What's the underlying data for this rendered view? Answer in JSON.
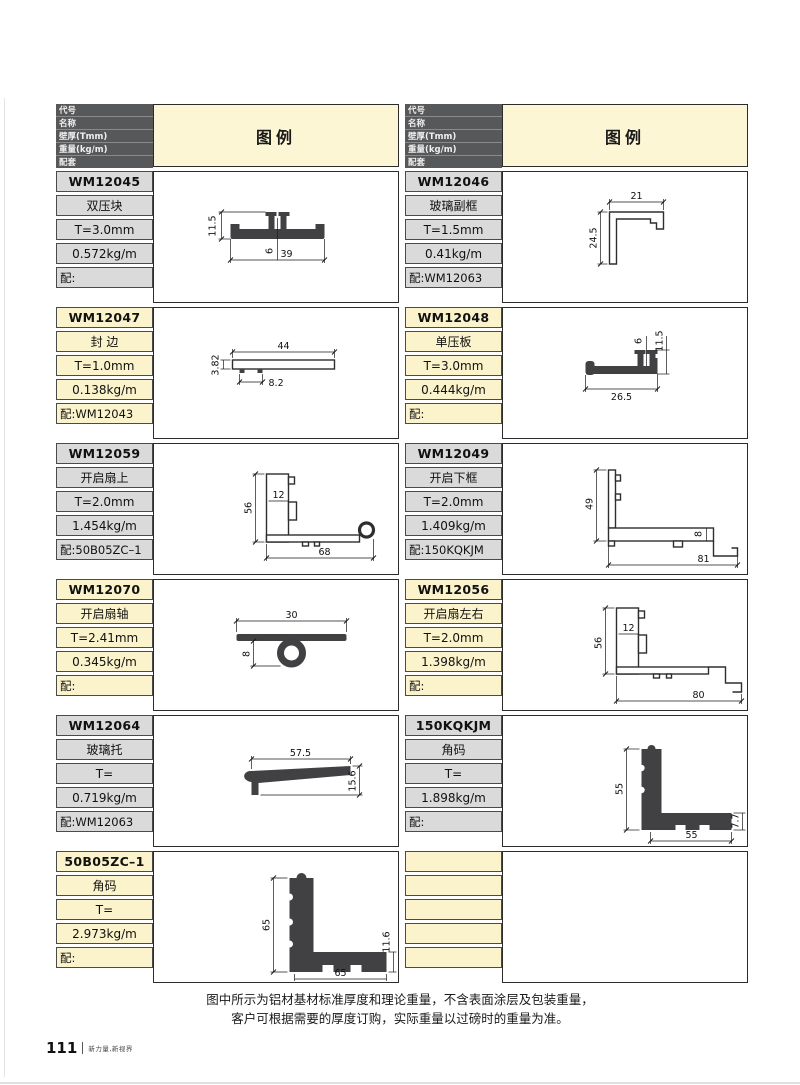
{
  "header": {
    "rows": [
      "代号",
      "名称",
      "壁厚(Tmm)",
      "重量(kg/m)",
      "配套"
    ],
    "legend": "图例"
  },
  "entries": {
    "left": [
      {
        "code": "WM12045",
        "name": "双压块",
        "thickness": "T=3.0mm",
        "weight": "0.572kg/m",
        "match": "配:",
        "dims": [
          "11.5",
          "6",
          "39"
        ]
      },
      {
        "code": "WM12047",
        "name": "封 边",
        "thickness": "T=1.0mm",
        "weight": "0.138kg/m",
        "match": "配:WM12043",
        "dims": [
          "3.82",
          "44",
          "8.2"
        ]
      },
      {
        "code": "WM12059",
        "name": "开启扇上",
        "thickness": "T=2.0mm",
        "weight": "1.454kg/m",
        "match": "配:50B05ZC–1",
        "dims": [
          "56",
          "12",
          "68"
        ]
      },
      {
        "code": "WM12070",
        "name": "开启扇轴",
        "thickness": "T=2.41mm",
        "weight": "0.345kg/m",
        "match": "配:",
        "dims": [
          "30",
          "8"
        ]
      },
      {
        "code": "WM12064",
        "name": "玻璃托",
        "thickness": "T=",
        "weight": "0.719kg/m",
        "match": "配:WM12063",
        "dims": [
          "57.5",
          "15.6"
        ]
      },
      {
        "code": "50B05ZC–1",
        "name": "角码",
        "thickness": "T=",
        "weight": "2.973kg/m",
        "match": "配:",
        "dims": [
          "65",
          "11.6",
          "65"
        ]
      }
    ],
    "right": [
      {
        "code": "WM12046",
        "name": "玻璃副框",
        "thickness": "T=1.5mm",
        "weight": "0.41kg/m",
        "match": "配:WM12063",
        "dims": [
          "21",
          "24.5"
        ]
      },
      {
        "code": "WM12048",
        "name": "单压板",
        "thickness": "T=3.0mm",
        "weight": "0.444kg/m",
        "match": "配:",
        "dims": [
          "6",
          "11.5",
          "26.5"
        ]
      },
      {
        "code": "WM12049",
        "name": "开启下框",
        "thickness": "T=2.0mm",
        "weight": "1.409kg/m",
        "match": "配:150KQKJM",
        "dims": [
          "49",
          "8",
          "81"
        ]
      },
      {
        "code": "WM12056",
        "name": "开启扇左右",
        "thickness": "T=2.0mm",
        "weight": "1.398kg/m",
        "match": "配:",
        "dims": [
          "56",
          "12",
          "80"
        ]
      },
      {
        "code": "150KQKJM",
        "name": "角码",
        "thickness": "T=",
        "weight": "1.898kg/m",
        "match": "配:",
        "dims": [
          "55",
          "55",
          "7.7"
        ]
      },
      {
        "code": "",
        "name": "",
        "thickness": "",
        "weight": "",
        "match": "",
        "dims": []
      }
    ]
  },
  "footer": {
    "line1": "图中所示为铝材基材标准厚度和理论重量，不含表面涂层及包装重量，",
    "line2": "客户可根据需要的厚度订购，实际重量以过磅时的重量为准。"
  },
  "pagebar": {
    "number": "111",
    "tagline": "新力量,新视界"
  },
  "colors": {
    "header_bg": "#57585a",
    "gray_cell": "#dadada",
    "yellow_cell": "#faf3cb",
    "legend_bg": "#fcf6d4",
    "cell_border": "#4a4a4a"
  }
}
